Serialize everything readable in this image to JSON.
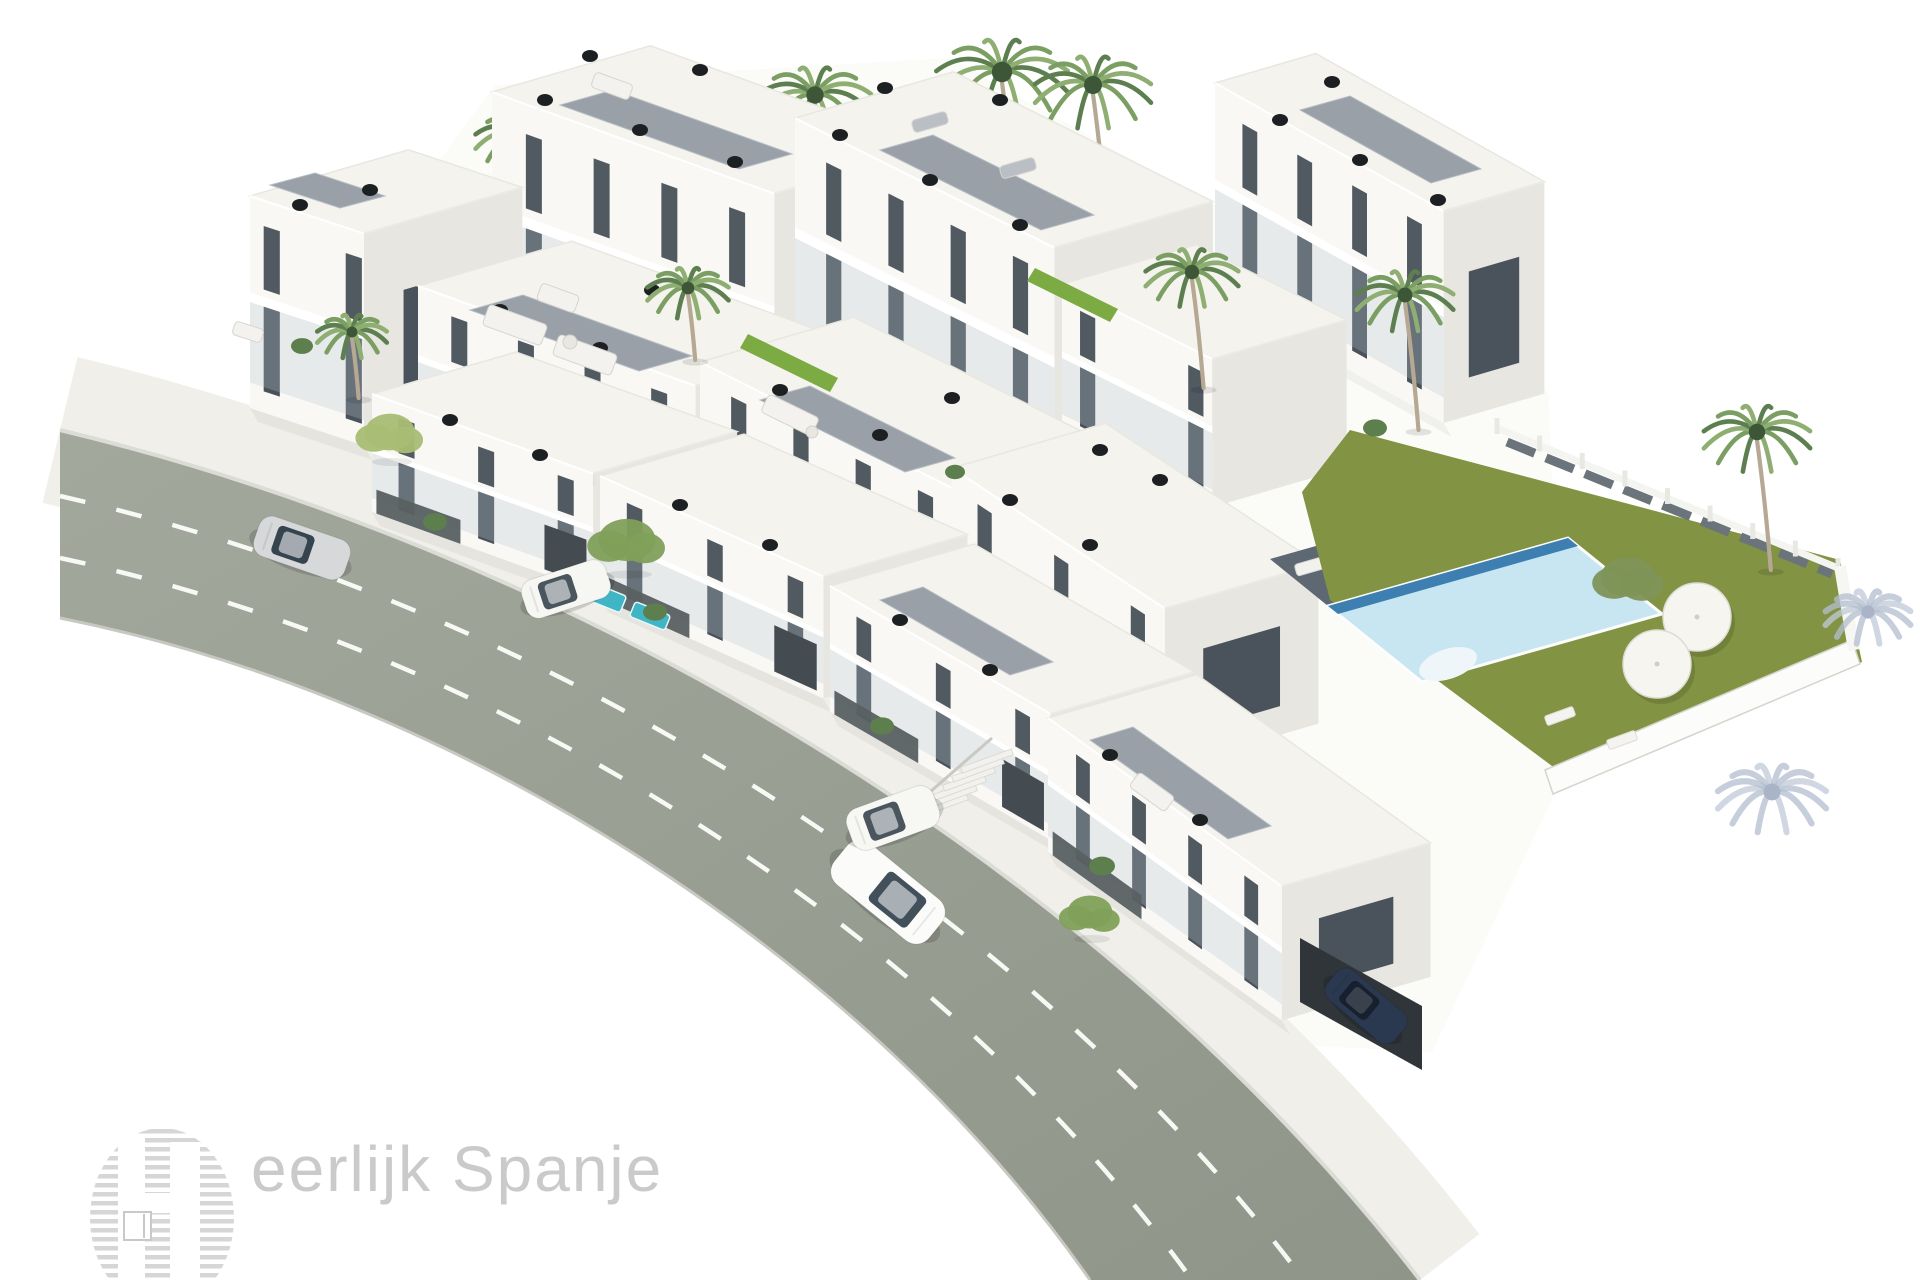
{
  "watermark": {
    "text": "eerlijk Spanje",
    "text_color": "#c8c8c8",
    "logo_stripe_color": "#d6d6d6"
  },
  "palette": {
    "background": "#ffffff",
    "road": "#9aa094",
    "road_dark": "#8f9589",
    "sidewalk": "#f0efe9",
    "curb": "#dcdcd6",
    "lane": "#fdfdfa",
    "face_front": "#f9f8f5",
    "face_end": "#e7e6e1",
    "face_top": "#f4f3ee",
    "window": "#49525a",
    "roof_panel": "#99a0a8",
    "chimney": "#1d2022",
    "grass": "#829343",
    "pool_light": "#c8e6f1",
    "pool_dark": "#3c7fb0",
    "deck": "#5d6873",
    "palm_green": "#7b9f63",
    "shadow_blue": "#b3becf",
    "plunge": "#3fb5c6"
  },
  "scene": {
    "w": 1920,
    "h": 1280,
    "sitePoly": [
      [
        250,
        420
      ],
      [
        495,
        85
      ],
      [
        950,
        58
      ],
      [
        1548,
        392
      ],
      [
        1565,
        772
      ],
      [
        1432,
        1052
      ],
      [
        1052,
        1032
      ],
      [
        398,
        602
      ]
    ],
    "road": {
      "top": "M60,430 C540,545 1080,840 1420,1280",
      "shape": "M60,430 C540,545 1080,840 1420,1280 L1090,1280 C870,965 470,700 60,618 Z",
      "bottom": "M60,618 C470,700 870,965 1090,1280",
      "lanes": [
        "M60,496 C515,599 1006,884 1304,1280",
        "M60,558 C492,650 936,925 1192,1280"
      ],
      "sidewalk_width": 150
    },
    "blocks": [
      {
        "id": "back-right",
        "x": 1215,
        "y": 295,
        "s": 0.56,
        "L": 262,
        "D": 105,
        "H": 212,
        "n": 4,
        "endWin": 1
      },
      {
        "id": "back-left",
        "x": 492,
        "y": 340,
        "s": 0.36,
        "L": 300,
        "D": 165,
        "H": 248,
        "n": 4
      },
      {
        "id": "back-mid",
        "x": 795,
        "y": 358,
        "s": 0.5,
        "L": 290,
        "D": 165,
        "H": 240,
        "n": 4
      },
      {
        "id": "back-link",
        "x": 1062,
        "y": 432,
        "s": 0.5,
        "L": 168,
        "D": 140,
        "H": 148,
        "n": 2
      },
      {
        "id": "villa",
        "x": 250,
        "y": 408,
        "s": 0.33,
        "L": 120,
        "D": 165,
        "H": 212,
        "n": 2,
        "endWin": 1
      },
      {
        "id": "mid-left",
        "x": 418,
        "y": 438,
        "s": 0.36,
        "L": 295,
        "D": 160,
        "H": 152,
        "n": 4
      },
      {
        "id": "mid-mid",
        "x": 700,
        "y": 520,
        "s": 0.5,
        "L": 290,
        "D": 160,
        "H": 158,
        "n": 4
      },
      {
        "id": "mid-right",
        "x": 952,
        "y": 628,
        "s": 0.66,
        "L": 255,
        "D": 160,
        "H": 160,
        "n": 3,
        "endWin": 1
      }
    ],
    "frontBlocks": [
      {
        "id": "front-1",
        "x": 372,
        "y": 512,
        "s": 0.36,
        "L": 235,
        "D": 150,
        "H": 118,
        "n": 3,
        "fence": 1,
        "garage": 1
      },
      {
        "id": "front-2",
        "x": 600,
        "y": 598,
        "s": 0.45,
        "L": 245,
        "D": 150,
        "H": 122,
        "n": 3,
        "fence": 1,
        "garage": 1
      },
      {
        "id": "front-3",
        "x": 830,
        "y": 712,
        "s": 0.58,
        "L": 255,
        "D": 150,
        "H": 126,
        "n": 3,
        "fence": 1,
        "garage": 1
      },
      {
        "id": "front-4",
        "x": 1048,
        "y": 852,
        "s": 0.72,
        "L": 288,
        "D": 155,
        "H": 134,
        "n": 4,
        "fence": 1,
        "endWin": 1
      }
    ],
    "roofPanels": [
      [
        [
          270,
          185
        ],
        [
          340,
          208
        ],
        [
          385,
          196
        ],
        [
          315,
          173
        ]
      ],
      [
        [
          560,
          105
        ],
        [
          739,
          169
        ],
        [
          792,
          154
        ],
        [
          613,
          90
        ]
      ],
      [
        [
          880,
          150
        ],
        [
          1041,
          230
        ],
        [
          1094,
          215
        ],
        [
          933,
          135
        ]
      ],
      [
        [
          1300,
          110
        ],
        [
          1431,
          183
        ],
        [
          1481,
          169
        ],
        [
          1350,
          96
        ]
      ],
      [
        [
          470,
          310
        ],
        [
          639,
          371
        ],
        [
          692,
          356
        ],
        [
          523,
          295
        ]
      ],
      [
        [
          760,
          400
        ],
        [
          905,
          472
        ],
        [
          955,
          458
        ],
        [
          810,
          386
        ]
      ],
      [
        [
          880,
          600
        ],
        [
          1010,
          675
        ],
        [
          1053,
          662
        ],
        [
          923,
          587
        ]
      ],
      [
        [
          1090,
          740
        ],
        [
          1228,
          839
        ],
        [
          1271,
          826
        ],
        [
          1133,
          727
        ]
      ]
    ],
    "hedges": [
      [
        [
          748,
          334
        ],
        [
          838,
          378
        ],
        [
          830,
          392
        ],
        [
          740,
          348
        ]
      ],
      [
        [
          1035,
          268
        ],
        [
          1118,
          309
        ],
        [
          1110,
          322
        ],
        [
          1027,
          281
        ]
      ]
    ],
    "chimneys": [
      [
        300,
        205
      ],
      [
        370,
        190
      ],
      [
        545,
        100
      ],
      [
        640,
        130
      ],
      [
        735,
        162
      ],
      [
        700,
        70
      ],
      [
        590,
        56
      ],
      [
        840,
        135
      ],
      [
        930,
        180
      ],
      [
        1020,
        225
      ],
      [
        1000,
        100
      ],
      [
        885,
        88
      ],
      [
        1280,
        120
      ],
      [
        1360,
        160
      ],
      [
        1438,
        200
      ],
      [
        1332,
        82
      ],
      [
        1100,
        450
      ],
      [
        1160,
        480
      ],
      [
        500,
        310
      ],
      [
        600,
        348
      ],
      [
        652,
        290
      ],
      [
        780,
        390
      ],
      [
        880,
        435
      ],
      [
        952,
        398
      ],
      [
        1010,
        500
      ],
      [
        1090,
        545
      ],
      [
        450,
        420
      ],
      [
        540,
        455
      ],
      [
        680,
        505
      ],
      [
        770,
        545
      ],
      [
        900,
        620
      ],
      [
        990,
        670
      ],
      [
        1110,
        755
      ],
      [
        1200,
        820
      ]
    ],
    "deck": {
      "quad": [
        [
          1270,
          559
        ],
        [
          1510,
          491
        ],
        [
          1568,
          538
        ],
        [
          1328,
          606
        ]
      ],
      "loungers": [
        [
          1315,
          565
        ],
        [
          1358,
          552
        ],
        [
          1401,
          539
        ],
        [
          1444,
          526
        ]
      ]
    },
    "pool": {
      "quad": [
        [
          1328,
          606
        ],
        [
          1568,
          538
        ],
        [
          1662,
          614
        ],
        [
          1422,
          682
        ]
      ],
      "stripe": [
        [
          1328,
          606
        ],
        [
          1568,
          538
        ],
        [
          1578,
          546
        ],
        [
          1338,
          614
        ]
      ],
      "steps": [
        1448,
        664
      ]
    },
    "lawn": {
      "poly": [
        [
          1350,
          430
        ],
        [
          1840,
          560
        ],
        [
          1862,
          662
        ],
        [
          1560,
          772
        ],
        [
          1330,
          600
        ],
        [
          1302,
          492
        ]
      ],
      "parasols": [
        [
          1697,
          617,
          34
        ],
        [
          1657,
          664,
          34
        ]
      ],
      "loungers": [
        [
          1622,
          740
        ],
        [
          1560,
          716
        ]
      ],
      "tree": [
        1628,
        577,
        44
      ],
      "palm": [
        1757,
        432,
        55,
        570
      ]
    },
    "fence": {
      "x1": 1497,
      "y1": 428,
      "x2": 1838,
      "y2": 568,
      "wall": [
        [
          1545,
          770
        ],
        [
          1852,
          640
        ],
        [
          1860,
          664
        ],
        [
          1553,
          794
        ]
      ],
      "ret": [
        1840,
        566,
        1854,
        650
      ]
    },
    "palmsBack": [
      [
        520,
        135,
        46,
        210
      ],
      [
        815,
        95,
        58,
        240
      ],
      [
        1002,
        72,
        68,
        300
      ],
      [
        1093,
        85,
        60,
        270
      ]
    ],
    "palmsFront": [
      [
        352,
        332,
        36,
        398
      ],
      [
        688,
        288,
        42,
        360
      ],
      [
        1192,
        272,
        48,
        388
      ],
      [
        1405,
        295,
        50,
        430
      ]
    ],
    "trees": [
      [
        390,
        432,
        40,
        "#a9bd74"
      ],
      [
        627,
        540,
        46,
        "#7fa05a"
      ],
      [
        1090,
        912,
        36,
        "#7fa05a"
      ]
    ],
    "shrubs": [
      [
        435,
        522,
        12
      ],
      [
        655,
        612,
        12
      ],
      [
        882,
        726,
        12
      ],
      [
        1102,
        866,
        13
      ],
      [
        302,
        346,
        11
      ],
      [
        1375,
        428,
        12
      ],
      [
        955,
        472,
        10
      ]
    ],
    "furniture": [
      [
        515,
        325,
        62,
        22,
        20,
        "#f3f2ee"
      ],
      [
        585,
        355,
        62,
        22,
        20,
        "#f3f2ee"
      ],
      [
        558,
        298,
        40,
        18,
        20,
        "#f3f2ee"
      ],
      [
        790,
        415,
        56,
        20,
        26,
        "#f3f2ee"
      ],
      [
        612,
        86,
        40,
        16,
        20,
        "#f3f2ee"
      ],
      [
        1152,
        792,
        44,
        18,
        36,
        "#f3f2ee"
      ],
      [
        248,
        332,
        30,
        14,
        18,
        "#f3f2ee"
      ],
      [
        930,
        122,
        36,
        13,
        -16,
        "#b9bfc4"
      ],
      [
        1018,
        168,
        36,
        13,
        -16,
        "#b9bfc4"
      ]
    ],
    "tables": [
      [
        570,
        342,
        7
      ],
      [
        812,
        432,
        6
      ]
    ],
    "plunges": [
      [
        602,
        596,
        46,
        18,
        22
      ],
      [
        650,
        616,
        38,
        16,
        22
      ]
    ],
    "stairs": {
      "x": 942,
      "y": 806,
      "n": 6
    },
    "carport": {
      "quad": [
        [
          1300,
          938
        ],
        [
          1422,
          1006
        ],
        [
          1422,
          1070
        ],
        [
          1300,
          1002
        ]
      ]
    },
    "cars": [
      {
        "name": "car-silver",
        "x": 302,
        "y": 548,
        "rot": 19,
        "L": 96,
        "W": 42,
        "body": "#d7d8d9",
        "glass": "#36444f",
        "flip": 1
      },
      {
        "name": "car-white",
        "x": 888,
        "y": 892,
        "rot": 39,
        "L": 122,
        "W": 53,
        "body": "#fbfbf9",
        "glass": "#42505b"
      },
      {
        "name": "van-parked-left",
        "x": 566,
        "y": 589,
        "rot": -18,
        "L": 88,
        "W": 40,
        "body": "#f6f6f3",
        "glass": "#4a555e",
        "flip": 1
      },
      {
        "name": "van-parked-mid",
        "x": 893,
        "y": 818,
        "rot": -20,
        "L": 92,
        "W": 44,
        "body": "#f7f7f4",
        "glass": "#4a555e",
        "flip": 1
      },
      {
        "name": "car-navy",
        "x": 1366,
        "y": 1006,
        "rot": 40,
        "L": 88,
        "W": 38,
        "body": "#2b3950",
        "glass": "#17202e",
        "flip": 1,
        "dim": 1
      }
    ],
    "shadowPalms": [
      [
        1868,
        612,
        44
      ],
      [
        1772,
        792,
        56
      ]
    ]
  }
}
